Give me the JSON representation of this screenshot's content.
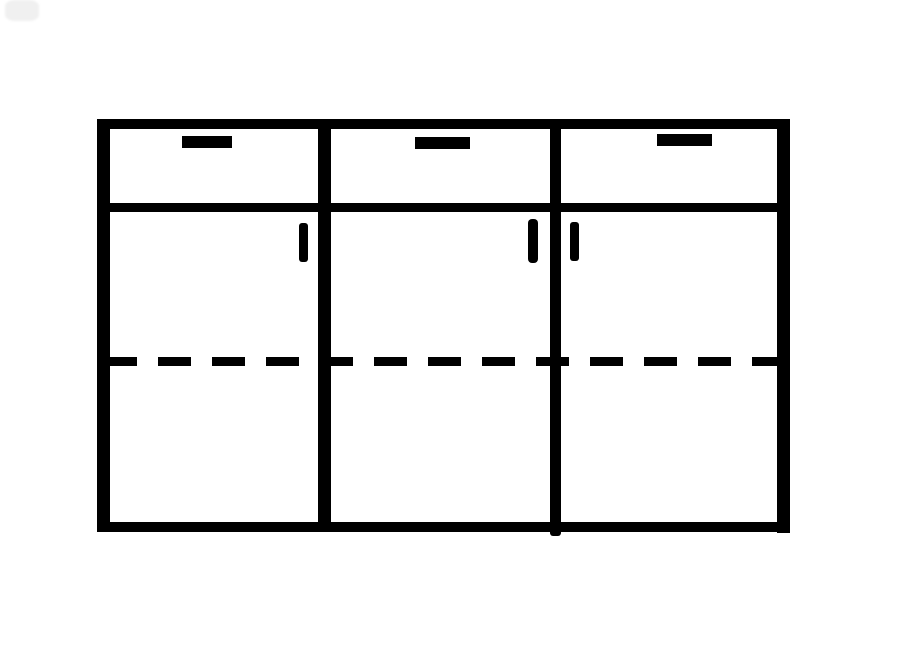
{
  "canvas": {
    "width": 900,
    "height": 650,
    "background_color": "#ffffff",
    "ink_color": "#000000",
    "smudge_color": "#f0f0f0"
  },
  "diagram": {
    "type": "furniture-line-drawing",
    "description": "Front-view black line drawing of a three-section sideboard cabinet: a row of three drawers across the top (each with a short horizontal pull), three doors below (each with a small vertical pull near a center divider), and a horizontal dashed line across the doors indicating an interior shelf. A faint gray smudge artifact sits in the top-left corner of the page.",
    "section_count": 3,
    "drawer_count": 3,
    "door_count": 3,
    "shapes": [
      {
        "name": "corner-smudge-artifact",
        "kind": "smudge",
        "x": 5,
        "y": 0,
        "w": 34,
        "h": 21
      },
      {
        "name": "cabinet-top-edge",
        "kind": "rect",
        "x": 97,
        "y": 119,
        "w": 693,
        "h": 10
      },
      {
        "name": "cabinet-left-edge",
        "kind": "rect",
        "x": 97,
        "y": 119,
        "w": 13,
        "h": 413
      },
      {
        "name": "cabinet-right-edge",
        "kind": "rect",
        "x": 777,
        "y": 119,
        "w": 13,
        "h": 414
      },
      {
        "name": "cabinet-bottom-edge",
        "kind": "rect",
        "x": 97,
        "y": 522,
        "w": 693,
        "h": 10
      },
      {
        "name": "drawer-row-divider-line",
        "kind": "rect",
        "x": 97,
        "y": 203,
        "w": 693,
        "h": 9
      },
      {
        "name": "section-divider-left",
        "kind": "rect",
        "x": 318,
        "y": 119,
        "w": 13,
        "h": 413
      },
      {
        "name": "section-divider-right",
        "kind": "rect",
        "x": 550,
        "y": 119,
        "w": 11,
        "h": 417,
        "radius": 3
      },
      {
        "name": "shelf-dashed-line",
        "kind": "dashed-line",
        "x": 104,
        "y": 357,
        "w": 680,
        "h": 9,
        "dash": 33,
        "gap": 21
      },
      {
        "name": "drawer-handle-left",
        "kind": "rect",
        "x": 182,
        "y": 136,
        "w": 50,
        "h": 12
      },
      {
        "name": "drawer-handle-middle",
        "kind": "rect",
        "x": 415,
        "y": 137,
        "w": 55,
        "h": 12
      },
      {
        "name": "drawer-handle-right",
        "kind": "rect",
        "x": 657,
        "y": 134,
        "w": 55,
        "h": 12
      },
      {
        "name": "door-handle-left-section",
        "kind": "rect",
        "x": 299,
        "y": 223,
        "w": 9,
        "h": 39,
        "radius": 3
      },
      {
        "name": "door-handle-middle-section",
        "kind": "rect",
        "x": 528,
        "y": 219,
        "w": 10,
        "h": 44,
        "radius": 4
      },
      {
        "name": "door-handle-right-section",
        "kind": "rect",
        "x": 570,
        "y": 222,
        "w": 9,
        "h": 39,
        "radius": 3
      }
    ]
  }
}
